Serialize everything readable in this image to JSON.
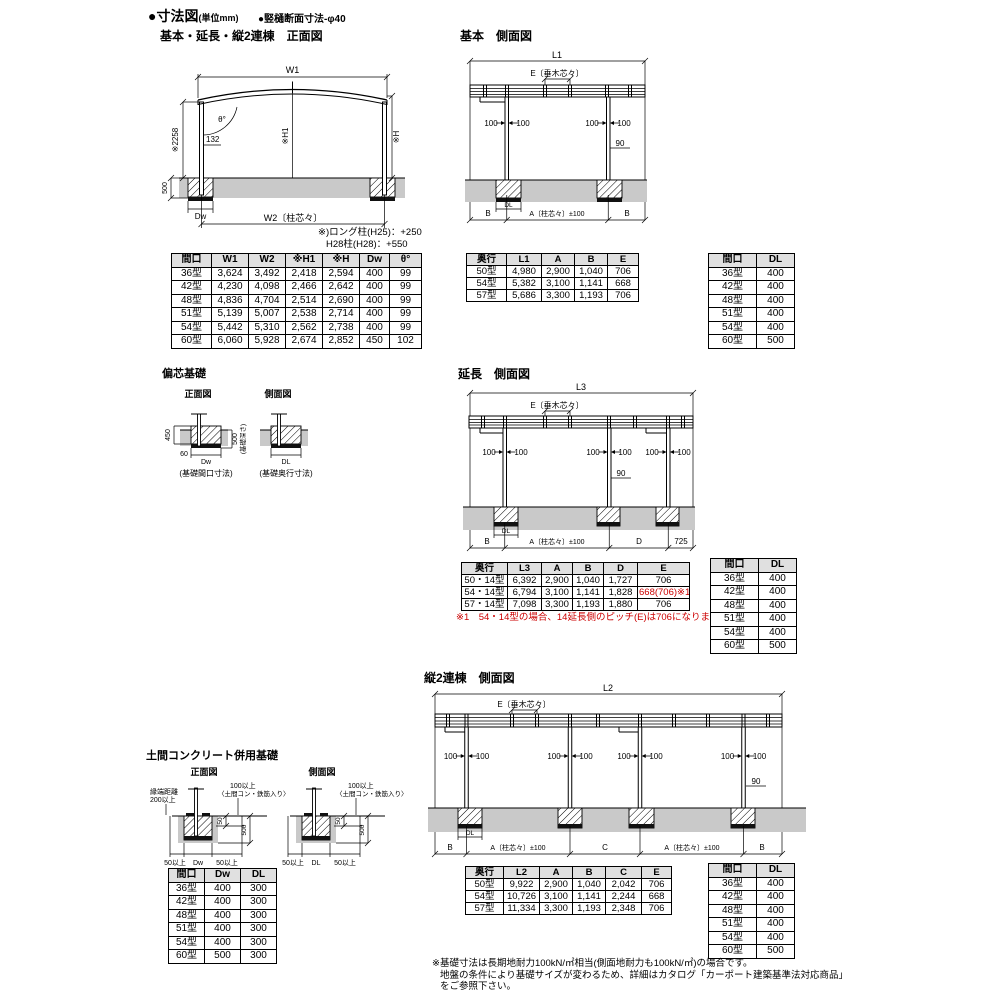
{
  "header": {
    "title": "●寸法図",
    "unit": "(単位mm)",
    "note": "●竪樋断面寸法-φ40"
  },
  "common": {
    "dim100": "100",
    "dim90": "90",
    "rafter_e": "E〔垂木芯々〕",
    "a_span": "A〔柱芯々〕±100",
    "b": "B",
    "dl": "DL",
    "dw": "Dw"
  },
  "front_view": {
    "title": "基本・延長・縦2連棟　正面図",
    "labels": {
      "w1": "W1",
      "w2": "W2〔柱芯々〕",
      "theta": "θ°",
      "h2258": "※2258",
      "len132": "132",
      "h1": "※H1",
      "h": "※H",
      "d500": "500"
    },
    "note_line1": "※)ロング柱(H25)：+250",
    "note_line2": "H28柱(H28)：+550",
    "table": {
      "headers": [
        "間口",
        "W1",
        "W2",
        "※H1",
        "※H",
        "Dw",
        "θ°"
      ],
      "rows": [
        [
          "36型",
          "3,624",
          "3,492",
          "2,418",
          "2,594",
          "400",
          "99"
        ],
        [
          "42型",
          "4,230",
          "4,098",
          "2,466",
          "2,642",
          "400",
          "99"
        ],
        [
          "48型",
          "4,836",
          "4,704",
          "2,514",
          "2,690",
          "400",
          "99"
        ],
        [
          "51型",
          "5,139",
          "5,007",
          "2,538",
          "2,714",
          "400",
          "99"
        ],
        [
          "54型",
          "5,442",
          "5,310",
          "2,562",
          "2,738",
          "400",
          "99"
        ],
        [
          "60型",
          "6,060",
          "5,928",
          "2,674",
          "2,852",
          "450",
          "102"
        ]
      ]
    }
  },
  "basic_side": {
    "title": "基本　側面図",
    "labels": {
      "l1": "L1"
    },
    "table": {
      "headers": [
        "奥行",
        "L1",
        "A",
        "B",
        "E"
      ],
      "rows": [
        [
          "50型",
          "4,980",
          "2,900",
          "1,040",
          "706"
        ],
        [
          "54型",
          "5,382",
          "3,100",
          "1,141",
          "668"
        ],
        [
          "57型",
          "5,686",
          "3,300",
          "1,193",
          "706"
        ]
      ]
    }
  },
  "extension_side": {
    "title": "延長　側面図",
    "labels": {
      "l3": "L3",
      "d": "D",
      "v725": "725"
    },
    "note": "※1　54・14型の場合、14延長側のピッチ(E)は706になります。",
    "table": {
      "headers": [
        "奥行",
        "L3",
        "A",
        "B",
        "D",
        "E"
      ],
      "rows": [
        [
          "50・14型",
          "6,392",
          "2,900",
          "1,040",
          "1,727",
          "706"
        ],
        [
          "54・14型",
          "6,794",
          "3,100",
          "1,141",
          "1,828",
          "668(706)※1"
        ],
        [
          "57・14型",
          "7,098",
          "3,300",
          "1,193",
          "1,880",
          "706"
        ]
      ]
    }
  },
  "double_side": {
    "title": "縦2連棟　側面図",
    "labels": {
      "l2": "L2",
      "c": "C"
    },
    "table": {
      "headers": [
        "奥行",
        "L2",
        "A",
        "B",
        "C",
        "E"
      ],
      "rows": [
        [
          "50型",
          "9,922",
          "2,900",
          "1,040",
          "2,042",
          "706"
        ],
        [
          "54型",
          "10,726",
          "3,100",
          "1,141",
          "2,244",
          "668"
        ],
        [
          "57型",
          "11,334",
          "3,300",
          "1,193",
          "2,348",
          "706"
        ]
      ]
    }
  },
  "mini_table": {
    "headers": [
      "間口",
      "DL"
    ],
    "rows": [
      [
        "36型",
        "400"
      ],
      [
        "42型",
        "400"
      ],
      [
        "48型",
        "400"
      ],
      [
        "51型",
        "400"
      ],
      [
        "54型",
        "400"
      ],
      [
        "60型",
        "500"
      ]
    ]
  },
  "eccentric": {
    "title": "偏芯基礎",
    "front_label": "正面図",
    "side_label": "側面図",
    "labels": {
      "v450": "450",
      "v60": "60",
      "v500": "500",
      "depth": "(基礎深さ)",
      "front_caption": "(基礎間口寸法)",
      "side_caption": "(基礎奥行寸法)"
    }
  },
  "slab": {
    "title": "土間コンクリート併用基礎",
    "front_label": "正面図",
    "side_label": "側面図",
    "labels": {
      "edge1": "縁端距離",
      "edge2": "200以上",
      "over100": "100以上",
      "rebar": "〈土間コン・鉄筋入り〉",
      "v50": "50",
      "v500": "500",
      "min50": "50以上"
    },
    "table": {
      "headers": [
        "間口",
        "Dw",
        "DL"
      ],
      "rows": [
        [
          "36型",
          "400",
          "300"
        ],
        [
          "42型",
          "400",
          "300"
        ],
        [
          "48型",
          "400",
          "300"
        ],
        [
          "51型",
          "400",
          "300"
        ],
        [
          "54型",
          "400",
          "300"
        ],
        [
          "60型",
          "500",
          "300"
        ]
      ]
    }
  },
  "footnotes": {
    "line1": "※基礎寸法は長期地耐力100kN/㎡相当(側面地耐力も100kN/㎡)の場合です。",
    "line2": "地盤の条件により基礎サイズが変わるため、詳細はカタログ「カーポート建築基準法対応商品」",
    "line3": "をご参照下さい。"
  },
  "colors": {
    "ground": "#c9c9c9",
    "table_header_bg": "#e0e0e0",
    "red": "#cc0000"
  }
}
